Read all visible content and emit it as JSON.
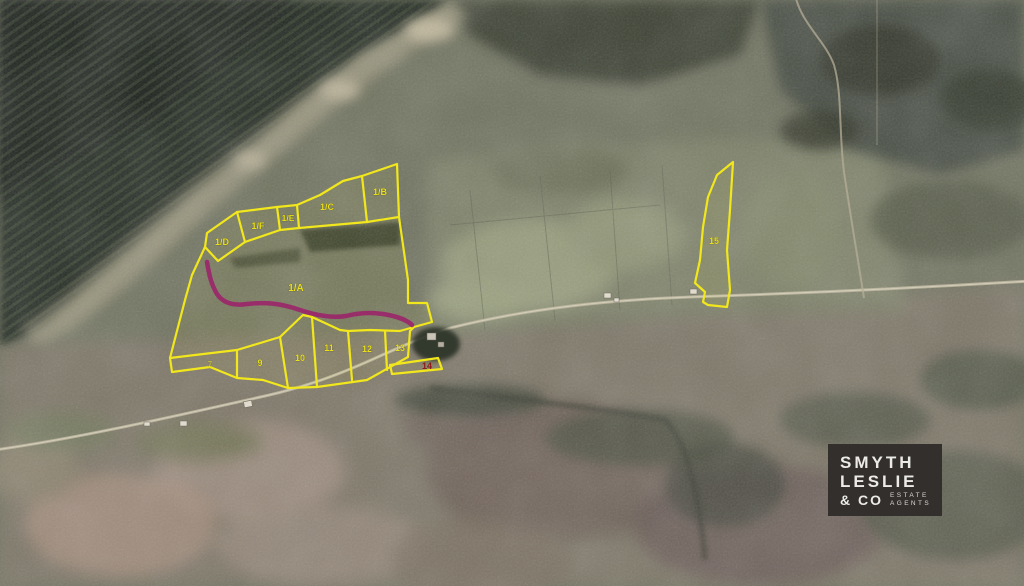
{
  "map": {
    "description": "Aerial photograph with land-for-sale parcel boundaries outlined in yellow and a magenta access track",
    "colors": {
      "parcel_boundary": "#f1e71c",
      "access_track": "#9c1e6a",
      "parcel_label": "#e9df1e",
      "parcel_label_red": "#8e1b15",
      "logo_background": "#322f2c",
      "logo_text": "#ecebe7"
    },
    "parcels": [
      {
        "label": "1/A"
      },
      {
        "label": "1/B"
      },
      {
        "label": "1/C"
      },
      {
        "label": "1/D"
      },
      {
        "label": "1/E"
      },
      {
        "label": "1/F"
      },
      {
        "label": "7"
      },
      {
        "label": "9"
      },
      {
        "label": "10"
      },
      {
        "label": "11"
      },
      {
        "label": "12"
      },
      {
        "label": "13"
      },
      {
        "label": "14"
      },
      {
        "label": "15"
      }
    ]
  },
  "logo": {
    "name": "Smyth Leslie & Co Estate Agents",
    "line1": "SMYTH",
    "line2": "LESLIE",
    "line3": "& CO",
    "tagline_line1": "ESTATE",
    "tagline_line2": "AGENTS"
  }
}
